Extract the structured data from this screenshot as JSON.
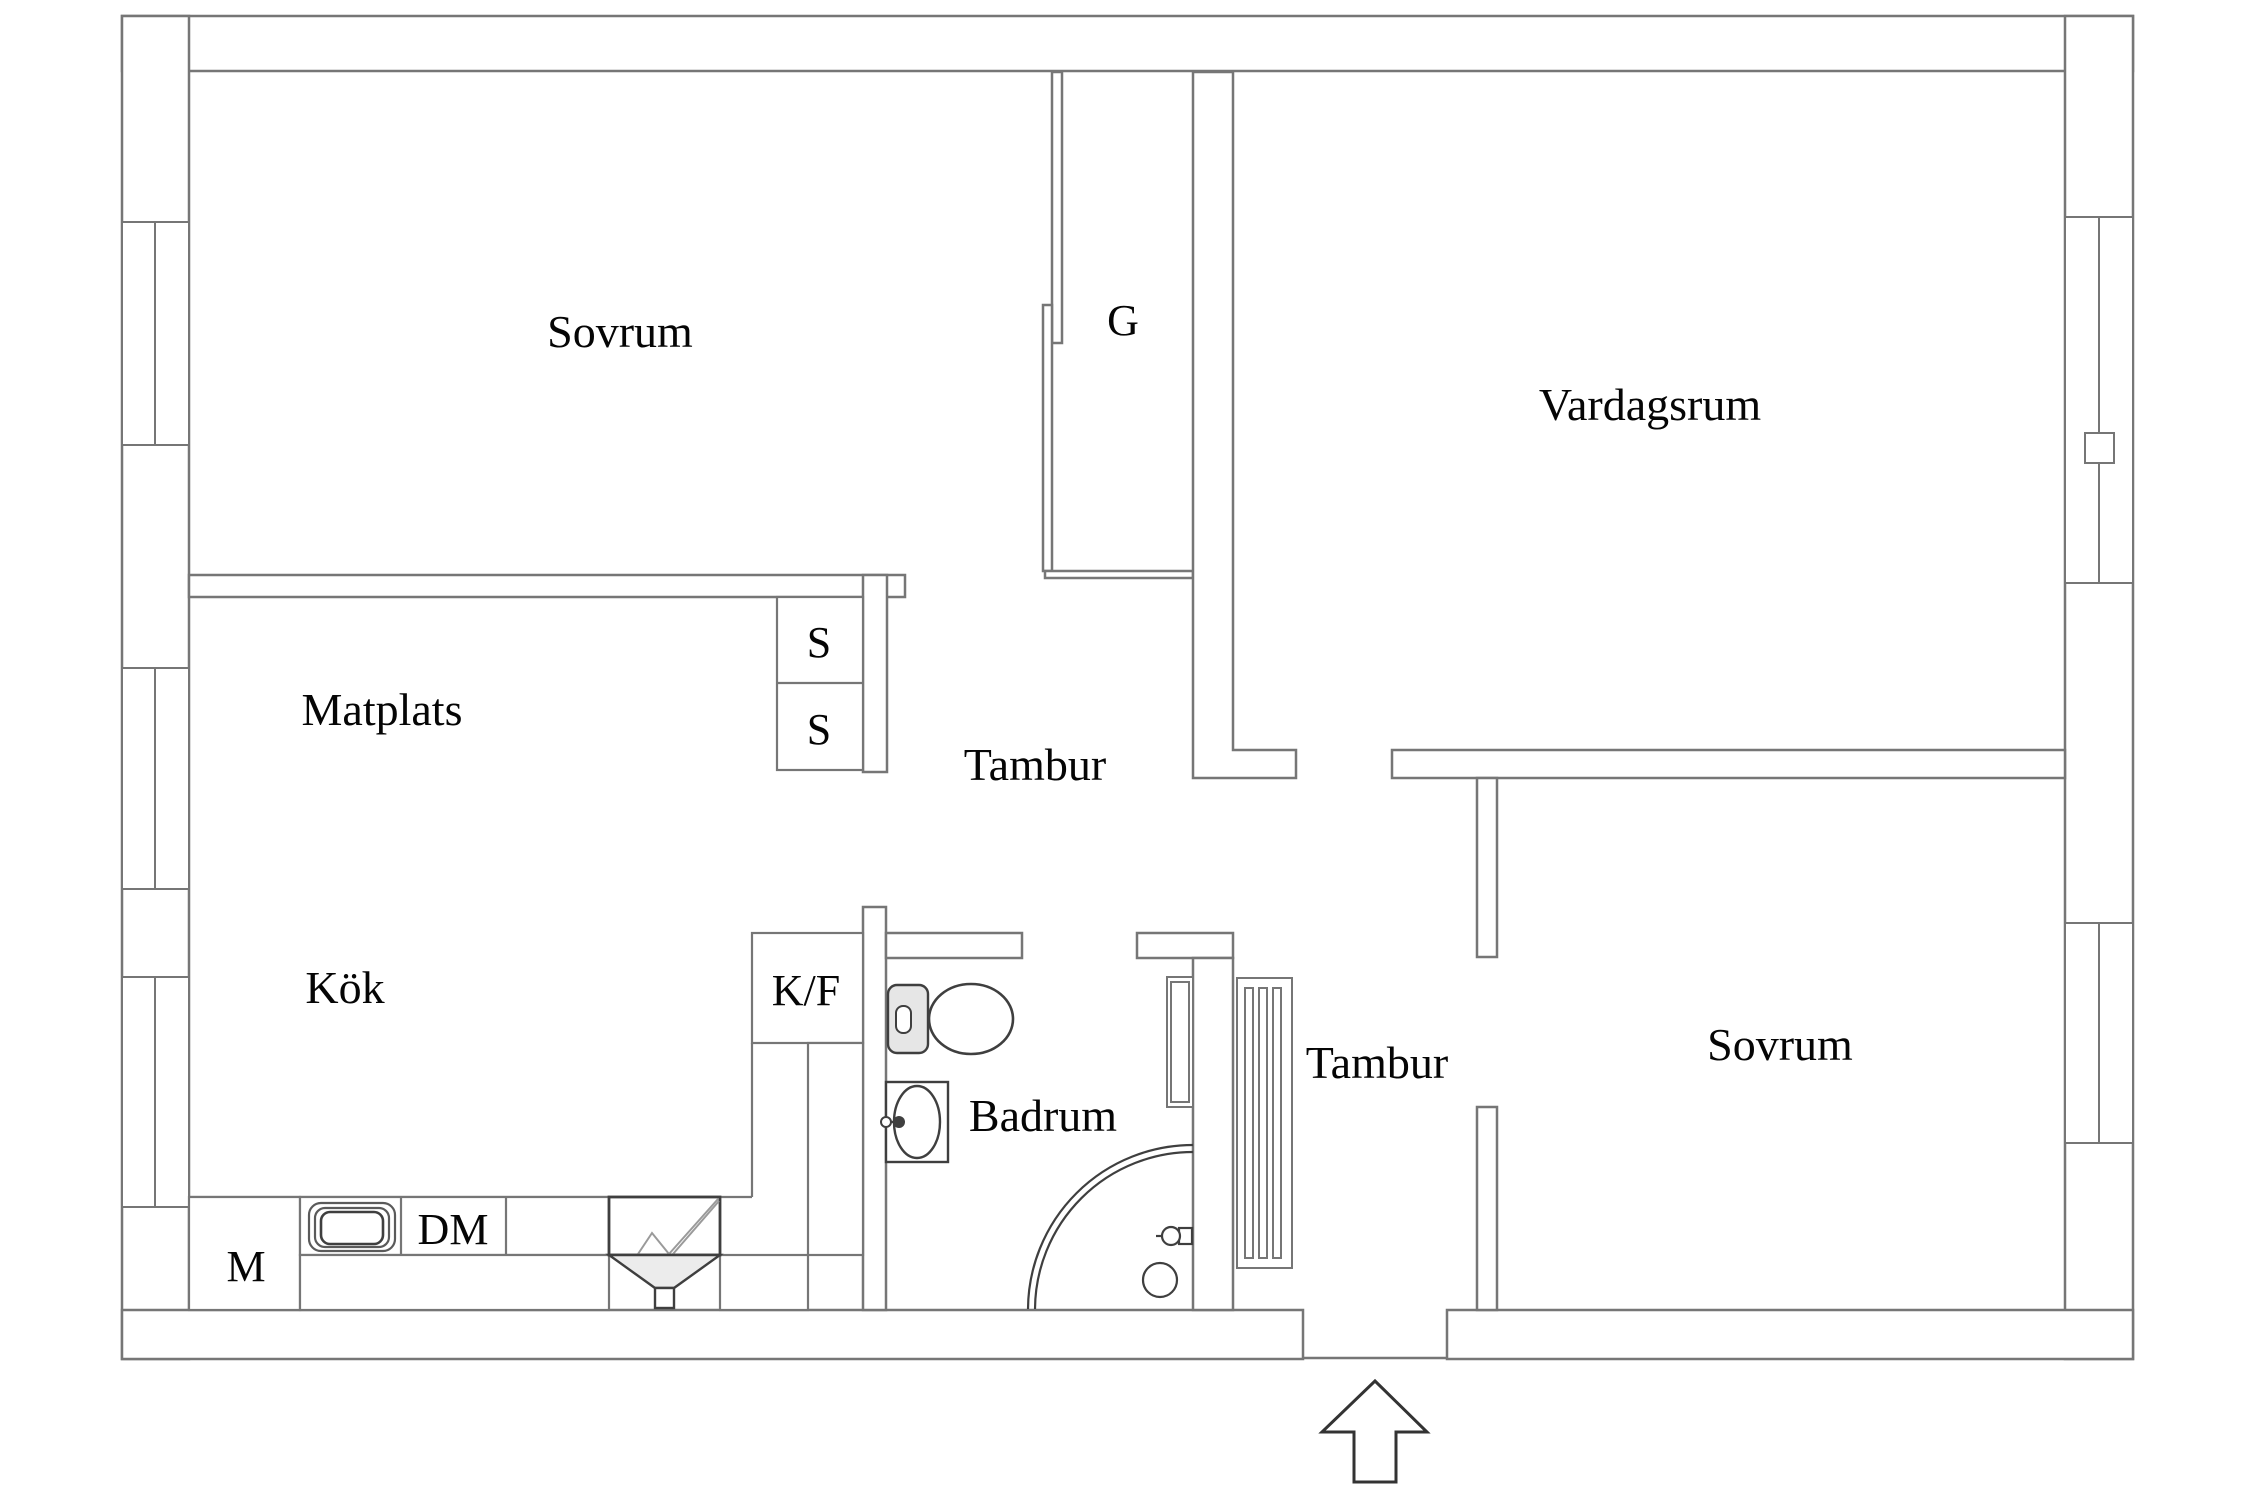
{
  "plan": {
    "title": "apartment-floor-plan",
    "rooms": {
      "sovrum1": "Sovrum",
      "garderob": "G",
      "vardagsrum": "Vardagsrum",
      "matplats": "Matplats",
      "closet_s1": "S",
      "closet_s2": "S",
      "tambur1": "Tambur",
      "kok": "Kök",
      "kyl_frys": "K/F",
      "badrum": "Badrum",
      "tambur2": "Tambur",
      "sovrum2": "Sovrum",
      "maskin": "M",
      "diskmaskin": "DM"
    },
    "icons": {
      "entrance_arrow": "up-arrow-entrance",
      "toilet": "toilet-icon",
      "washbasin": "washbasin-icon",
      "shower": "shower-corner-icon",
      "radiator": "radiator-icon",
      "stove": "stove-icon",
      "kitchen_sink": "kitchen-sink-icon",
      "window": "window-symbol"
    },
    "colors": {
      "wall_stroke": "#767676",
      "fixture_stroke": "#3f3f3f",
      "fill": "#ffffff",
      "shade": "#ececec",
      "tank_shade": "#e6e6e6",
      "text": "#050505"
    }
  }
}
